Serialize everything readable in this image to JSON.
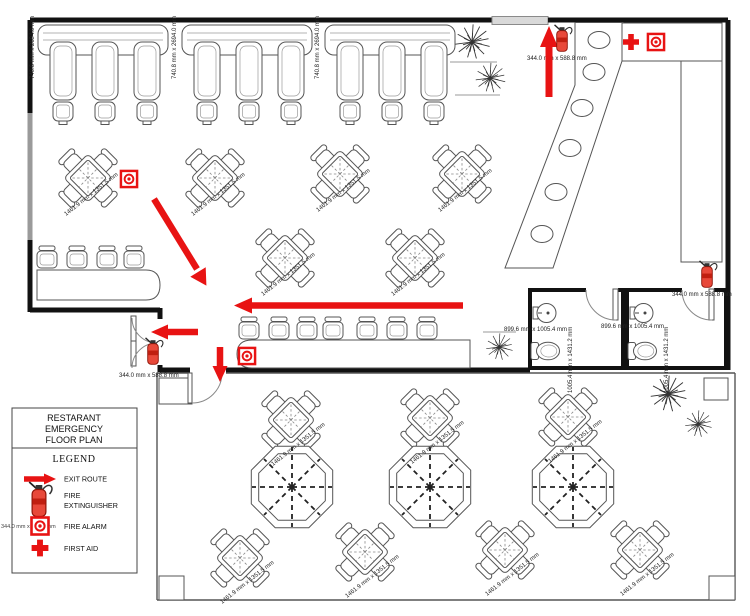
{
  "plan": {
    "booth_dims": [
      "740.6 mm x 2694.0 mm",
      "740.8 mm x 2694.0 mm",
      "740.8 mm x 2694.0 mm"
    ],
    "table_dim": "1461.9 mm x 1351.5 mm",
    "door_dim": "344.0 mm x 588.8 mm",
    "restroom_dim_h": "899.6 mm x 1005.4 mm",
    "restroom_dim_v": "1005.4 mm x 1431.2 mm"
  },
  "legend": {
    "title_lines": [
      "RESTARANT",
      "EMERGENCY",
      "FLOOR PLAN"
    ],
    "heading": "LEGEND",
    "items": [
      {
        "icon": "exit-route-arrow",
        "label": "EXIT ROUTE"
      },
      {
        "icon": "fire-extinguisher",
        "label_line1": "FIRE",
        "label_line2": "EXTINGUISHER",
        "dim": "344.0 mm x 588.8 mm"
      },
      {
        "icon": "fire-alarm",
        "label": "FIRE ALARM"
      },
      {
        "icon": "first-aid",
        "label": "FIRST AID"
      }
    ]
  },
  "colors": {
    "emergency_red": "#e81313",
    "extinguisher_body": "#e8493a",
    "wall": "#111111",
    "furniture_line": "#555555",
    "window_gray": "#9a9a9a"
  }
}
